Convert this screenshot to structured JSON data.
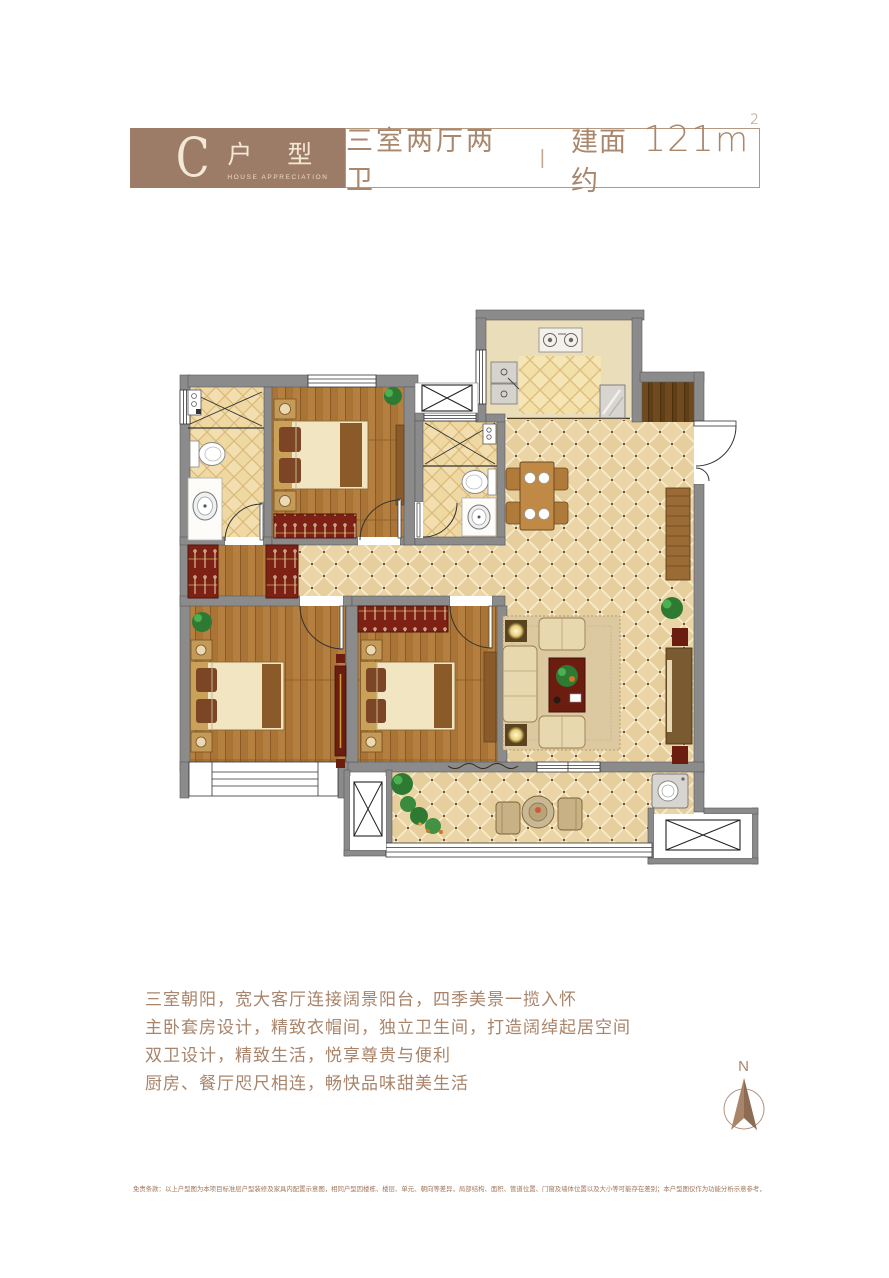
{
  "header": {
    "type_letter": "C",
    "type_name": "户 型",
    "type_subtitle": "HOUSE APPRECIATION",
    "layout_spec": "三室两厅两卫",
    "divider": "|",
    "area_prefix": "建面约",
    "area_number": "121",
    "area_unit_base": "m",
    "area_unit_sup": "2"
  },
  "description": {
    "lines": [
      "三室朝阳，宽大客厅连接阔景阳台，四季美景一揽入怀",
      "主卧套房设计，精致衣帽间，独立卫生间，打造阔绰起居空间",
      "双卫设计，精致生活，悦享尊贵与便利",
      "厨房、餐厅咫尺相连，畅快品味甜美生活"
    ]
  },
  "compass": {
    "label": "N"
  },
  "disclaimer": "免责条款：以上户型图为本项目标准层户型装修及家具内配置示意图，相同户型因楼栋、楼层、单元、朝向等差异，局部结构、面积、管道位置、门窗及墙体位置以及大小等可能存在差别；本户型图仅作为功能分析示意参考，不作为最终交付标准，交付标准以双方商品房买卖合同约定为准。",
  "colors": {
    "brand_brown": "#9c7c66",
    "text_brown": "#a8846a",
    "border_tan": "#b59880",
    "wall_gray": "#8b8b8b",
    "tile_beige": "#ebd5a6",
    "bath_tile": "#f2deae",
    "wood_brown": "#b5803f",
    "wardrobe_red": "#7c2113",
    "disclaimer_brown": "#a2745a"
  }
}
